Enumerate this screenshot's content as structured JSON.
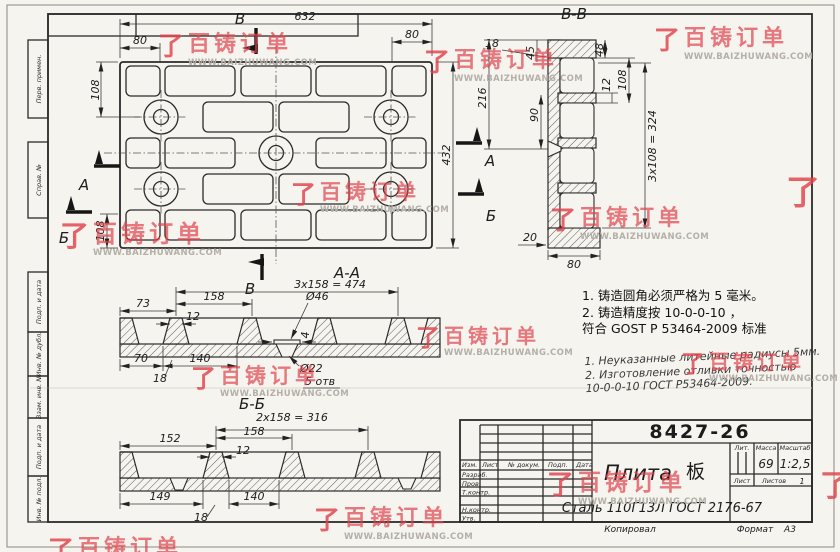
{
  "watermark": {
    "brand": "百铸订单",
    "url": "WWW.BAIZHUWANG.COM",
    "logo_glyph": "了",
    "color": "#e2484f"
  },
  "frame": {
    "left_labels": [
      "Перв. примен.",
      "Справ. №",
      "Подп. и дата",
      "Инв. № дубл.",
      "Взам. инв. №",
      "Подп. и дата",
      "Инв. № подл."
    ]
  },
  "plan": {
    "dims": {
      "length": "632",
      "end_left": "80",
      "end_right": "80",
      "row_offset": "108",
      "height": "432",
      "row_offset_bottom": "108"
    },
    "markers": {
      "b": "B",
      "a": "A",
      "g": "Б"
    }
  },
  "section_bb": {
    "label": "B-B",
    "dims": {
      "d18": "18",
      "d45": "45",
      "d48": "48",
      "d216": "216",
      "d90": "90",
      "d12": "12",
      "d108": "108",
      "pitch": "3x108 = 324",
      "d20": "20",
      "d80": "80"
    }
  },
  "section_aa": {
    "label": "A-A",
    "dims": {
      "pitch": "3x158 = 474",
      "d73": "73",
      "d158": "158",
      "d12": "12",
      "dia46": "Ø46",
      "d4": "4",
      "dia22": "Ø22",
      "holes": "5 отв",
      "d70": "70",
      "d140": "140",
      "d18": "18"
    }
  },
  "section_gg": {
    "label": "Б-Б",
    "dims": {
      "pitch": "2x158 = 316",
      "d152": "152",
      "d158": "158",
      "d12": "12",
      "d149": "149",
      "d140": "140",
      "d18": "18"
    }
  },
  "notes": {
    "chinese": [
      "1.  铸造圆角必须严格为 5 毫米。",
      "2.  铸造精度按 10-0-0-10 ，",
      "符合 GOST Р 53464-2009 标准"
    ],
    "russian": [
      "1. Неуказанные литейные радиусы 5мм.",
      "2. Изготовление  отливки  точностью",
      "10-0-0-10 ГОСТ Р53464-2009."
    ]
  },
  "title_block": {
    "doc_number": "8427-26",
    "name": "Плита",
    "name_cn": "板",
    "material": "Сталь 110Г13Л ГОСТ 2176-67",
    "cols": {
      "izm": "Изм.",
      "list": "Лист",
      "doc": "№ докум.",
      "sign": "Подп.",
      "date": "Дата"
    },
    "rows": [
      "Разраб.",
      "Пров.",
      "Т.контр.",
      "Н.контр.",
      "Утв."
    ],
    "lit": "Лит.",
    "mass_label": "Масса",
    "mass": "69",
    "scale_label": "Масштаб",
    "scale": "1:2,5",
    "sheet_label": "Лист",
    "sheets_label": "Листов",
    "sheets": "1",
    "format_label": "Формат",
    "format": "A3",
    "copied": "Копировал"
  }
}
